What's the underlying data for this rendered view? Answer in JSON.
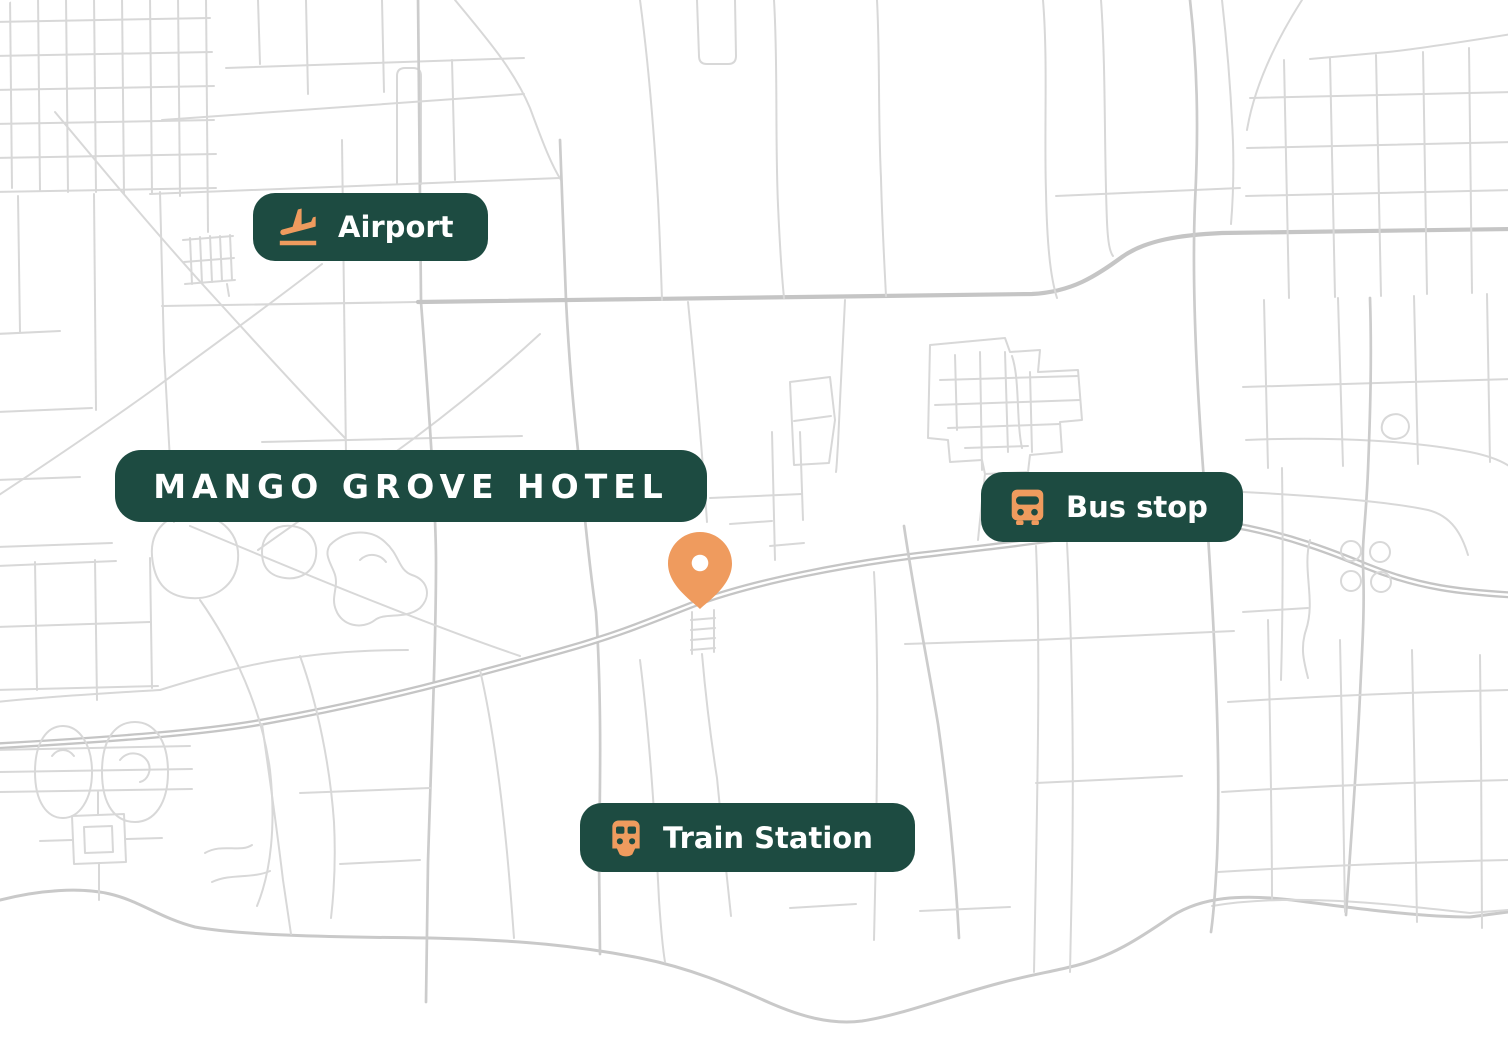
{
  "colors": {
    "pill_bg": "#1d4b41",
    "accent_orange": "#ef9b5e",
    "label_text": "#ffffff",
    "road": "#d8d8d8",
    "road_medium": "#cccccc",
    "road_major": "#c5c5c5",
    "water": "#f0f0f0",
    "coast": "#c9c9c9",
    "map_bg": "#ffffff"
  },
  "map": {
    "hotel": {
      "label": "MANGO GROVE HOTEL",
      "pin_icon": "map-pin-icon"
    },
    "markers": [
      {
        "id": "airport",
        "label": "Airport",
        "icon": "plane-landing-icon"
      },
      {
        "id": "bus-stop",
        "label": "Bus stop",
        "icon": "bus-icon"
      },
      {
        "id": "train-station",
        "label": "Train Station",
        "icon": "train-icon"
      }
    ]
  }
}
